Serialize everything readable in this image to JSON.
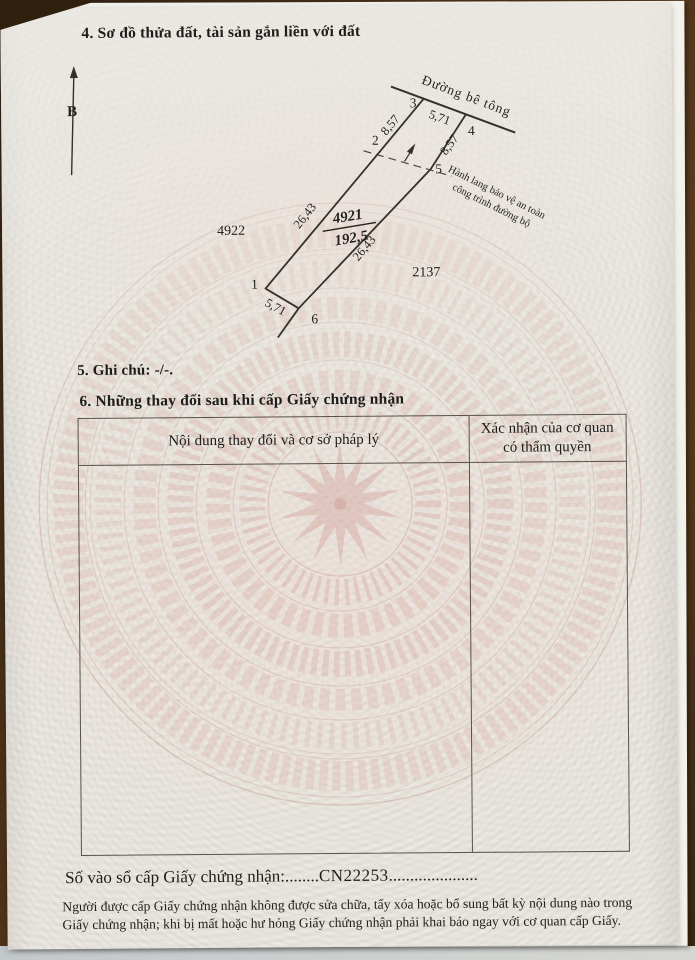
{
  "sections": {
    "section4_title": "4. Sơ đồ thửa đất, tài sản gắn liền với đất",
    "section5_title": "5. Ghi chú: -/-.",
    "section6_title": "6. Những thay đổi sau khi cấp Giấy chứng nhận"
  },
  "diagram": {
    "north_label": "B",
    "road_label": "Đường bê tông",
    "corridor_label_line1": "Hành lang bảo vệ an toàn",
    "corridor_label_line2": "công trình đường bộ",
    "parcel_number": "4921",
    "parcel_area": "192,5",
    "adjacent_parcel_left": "4922",
    "adjacent_parcel_right": "2137",
    "vertices": {
      "v1": "1",
      "v2": "2",
      "v3": "3",
      "v4": "4",
      "v5": "5",
      "v6": "6"
    },
    "dims": {
      "top": "5,71",
      "upper_left": "8,57",
      "upper_right": "8,57",
      "lower_left": "26,43",
      "lower_right": "26,43",
      "bottom": "5,71"
    }
  },
  "table": {
    "col1_header": "Nội dung thay đổi và cơ sở pháp lý",
    "col2_header_line1": "Xác nhận của cơ quan",
    "col2_header_line2": "có thẩm quyền"
  },
  "registry": {
    "label": "Số vào sổ cấp Giấy chứng nhận:",
    "dots_left": "........",
    "number": "CN22253",
    "dots_right": "....................."
  },
  "footer": {
    "note_line1": "Người được cấp Giấy chứng nhận không được sửa chữa, tẩy xóa hoặc bổ sung bất kỳ nội dung nào trong",
    "note_line2": "Giấy chứng nhận; khi bị mất hoặc hư hỏng Giấy chứng nhận phải khai báo ngay với cơ quan cấp Giấy."
  },
  "colors": {
    "paper": "#ebe9e2",
    "ink": "#1e1c1a",
    "watermark_pink": "#d39a90",
    "background_wood": "#4a3017"
  }
}
